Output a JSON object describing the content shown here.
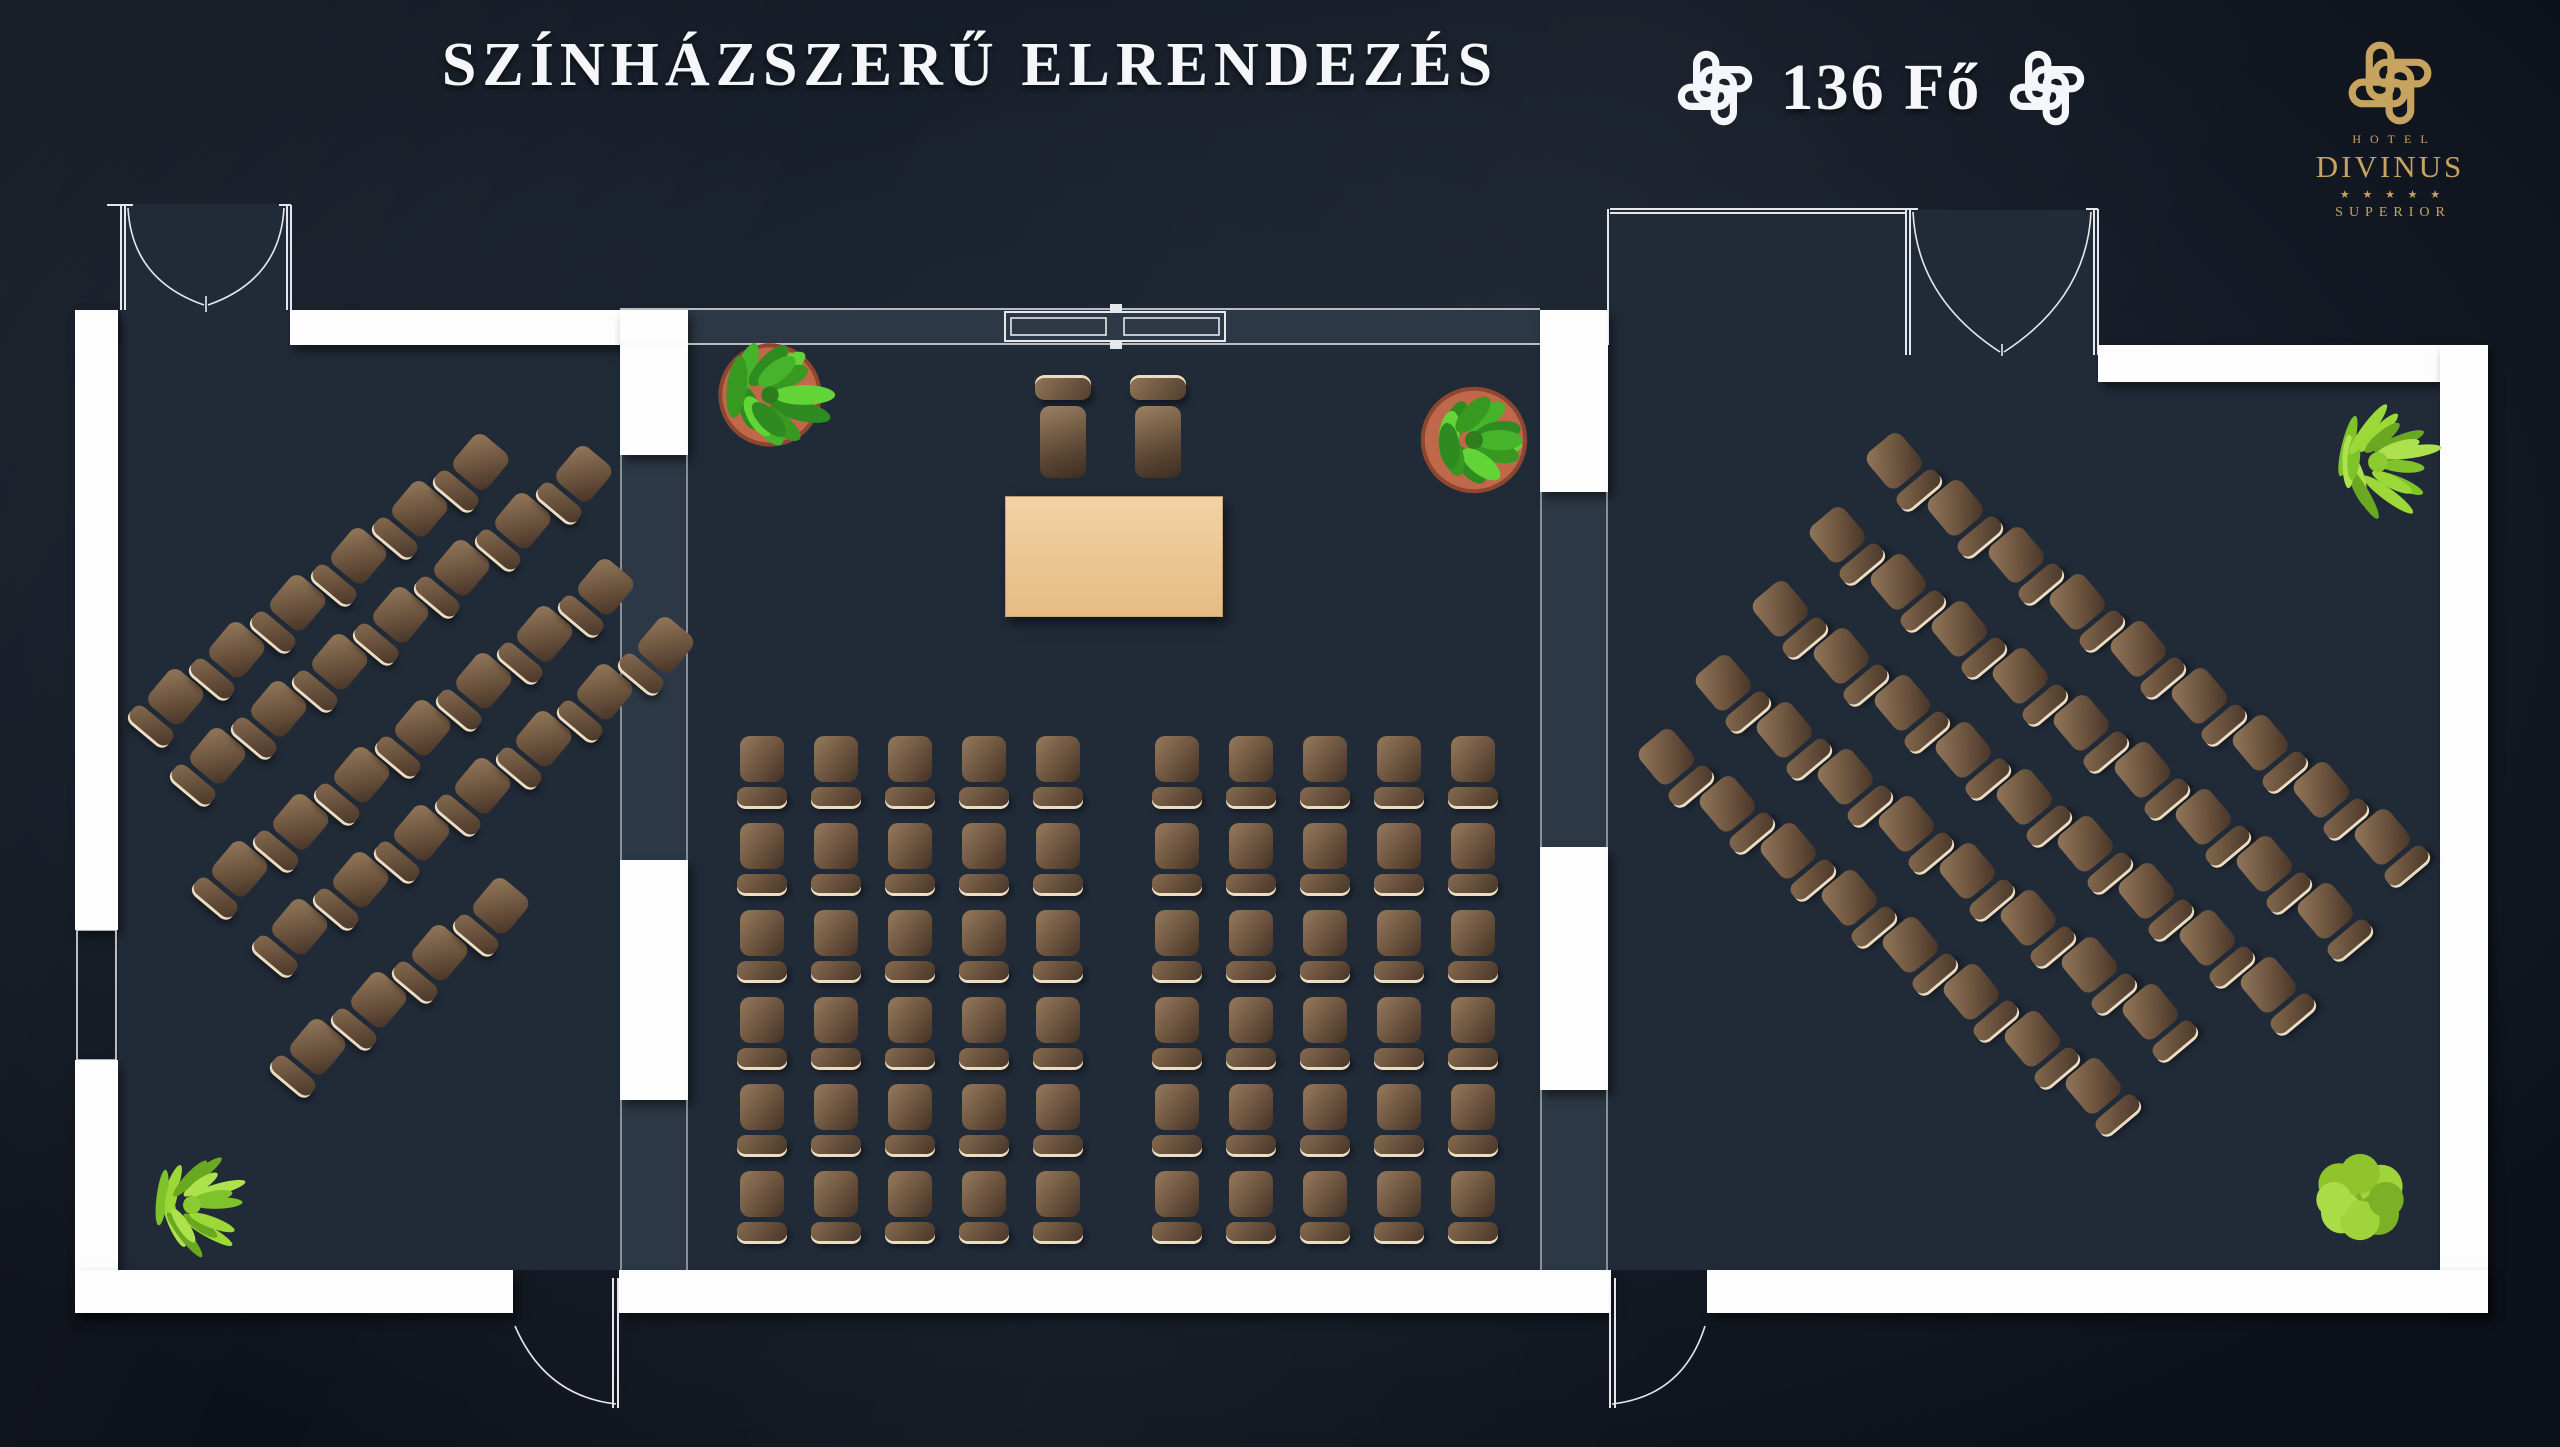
{
  "header": {
    "title": "SZÍNHÁZSZERŰ ELRENDEZÉS",
    "capacity_label": "136 Fő",
    "capacity_value": 136
  },
  "logo": {
    "hotel": "HOTEL",
    "name": "DIVINUS",
    "stars": "★ ★ ★ ★ ★",
    "superior": "SUPERIOR"
  },
  "icons": {
    "knot_white": "celtic-knot-icon",
    "knot_gold": "celtic-knot-icon"
  },
  "colors": {
    "background_outer": "#121822",
    "room_fill": "#212b38",
    "wall_band_fill": "#2c3845",
    "wall_white": "#fdfdfd",
    "gold": "#c7a360",
    "title_white": "#f4f6f9",
    "chair_brown_light": "#93785a",
    "chair_brown_dark": "#443226",
    "chair_edge_cream": "#ecdcc1",
    "table_tan": "#e9c28c",
    "plant_green": "#46b42a",
    "plant_lime": "#9ad23a",
    "pot_terracotta": "#c0694a"
  },
  "seating": {
    "layout_name": "theater",
    "total_chairs": 136,
    "presenter": {
      "table": {
        "x": 1005,
        "y": 496,
        "w": 216,
        "h": 119
      },
      "chairs": [
        {
          "x": 1035,
          "y": 378
        },
        {
          "x": 1130,
          "y": 378
        }
      ],
      "count": 2
    },
    "center_blocks": [
      {
        "x0": 737,
        "y0": 736,
        "cols": 5,
        "rows": 6,
        "col_pitch": 74,
        "row_pitch": 87,
        "count": 30
      },
      {
        "x0": 1152,
        "y0": 736,
        "cols": 5,
        "rows": 6,
        "col_pitch": 74,
        "row_pitch": 87,
        "count": 30
      }
    ],
    "left_room": {
      "rotation_deg": 40,
      "step": {
        "dx": 61,
        "dy": -47
      },
      "rows": [
        {
          "x": 168,
          "y": 706,
          "n": 6
        },
        {
          "x": 210,
          "y": 765,
          "n": 7
        },
        {
          "x": 232,
          "y": 878,
          "n": 7
        },
        {
          "x": 292,
          "y": 936,
          "n": 7
        },
        {
          "x": 310,
          "y": 1056,
          "n": 4
        }
      ],
      "count": 31
    },
    "right_room": {
      "rotation_deg": -40,
      "step": {
        "dx": 61,
        "dy": 47
      },
      "rows": [
        {
          "x": 1902,
          "y": 470,
          "n": 9
        },
        {
          "x": 1845,
          "y": 544,
          "n": 9
        },
        {
          "x": 1788,
          "y": 618,
          "n": 9
        },
        {
          "x": 1731,
          "y": 692,
          "n": 8
        },
        {
          "x": 1674,
          "y": 766,
          "n": 8
        }
      ],
      "count": 43
    }
  },
  "plants": [
    {
      "type": "potted",
      "x": 770,
      "y": 395,
      "r": 62
    },
    {
      "type": "potted",
      "x": 1474,
      "y": 440,
      "r": 64
    },
    {
      "type": "spiky",
      "x": 2378,
      "y": 462,
      "r": 62
    },
    {
      "type": "bush",
      "x": 2360,
      "y": 1197,
      "r": 52
    },
    {
      "type": "spiky",
      "x": 192,
      "y": 1205,
      "r": 56
    }
  ]
}
